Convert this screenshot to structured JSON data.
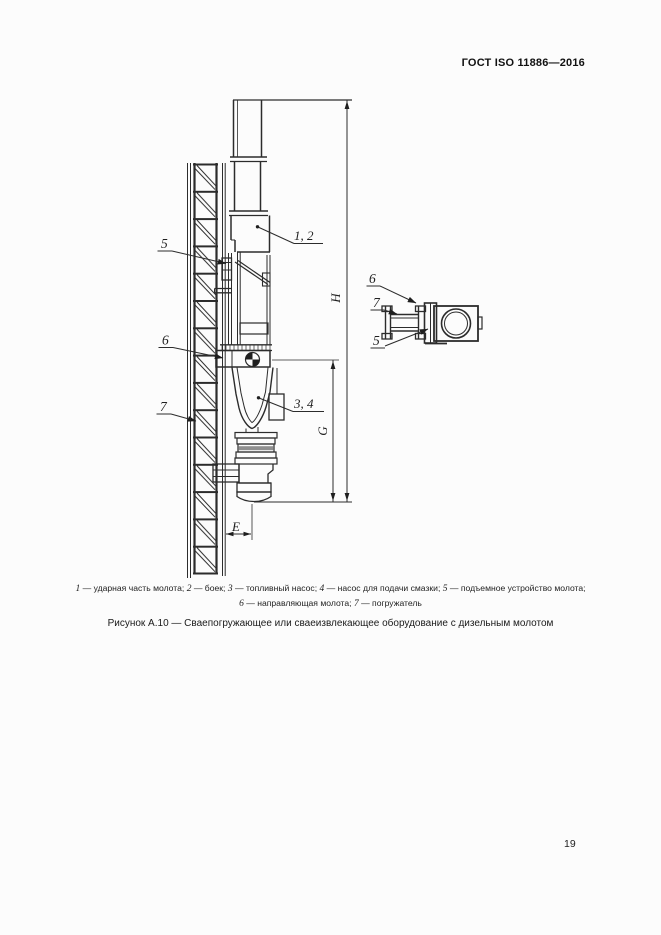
{
  "page": {
    "header_title": "ГОСТ ISO 11886—2016",
    "page_number": "19"
  },
  "figure": {
    "part_labels": {
      "hammer_body": "1, 2",
      "pumps": "3, 4",
      "hoist": "5",
      "guide": "6",
      "driver": "7"
    },
    "detail_labels": {
      "guide": "6",
      "driver": "7",
      "hoist": "5"
    },
    "dims": {
      "total_height": "H",
      "lower_height": "G",
      "offset": "E"
    },
    "legend": {
      "lines": [
        [
          {
            "num": "1",
            "text": "ударная часть молота"
          },
          {
            "num": "2",
            "text": "боек"
          },
          {
            "num": "3",
            "text": "топливный насос"
          },
          {
            "num": "4",
            "text": "насос для подачи смазки"
          },
          {
            "num": "5",
            "text": "подъемное устройство молота"
          }
        ],
        [
          {
            "num": "6",
            "text": "направляющая молота"
          },
          {
            "num": "7",
            "text": "погружатель"
          }
        ]
      ]
    },
    "caption": "Рисунок А.10 — Сваепогружающее или сваеизвлекающее оборудование с дизельным молотом"
  }
}
